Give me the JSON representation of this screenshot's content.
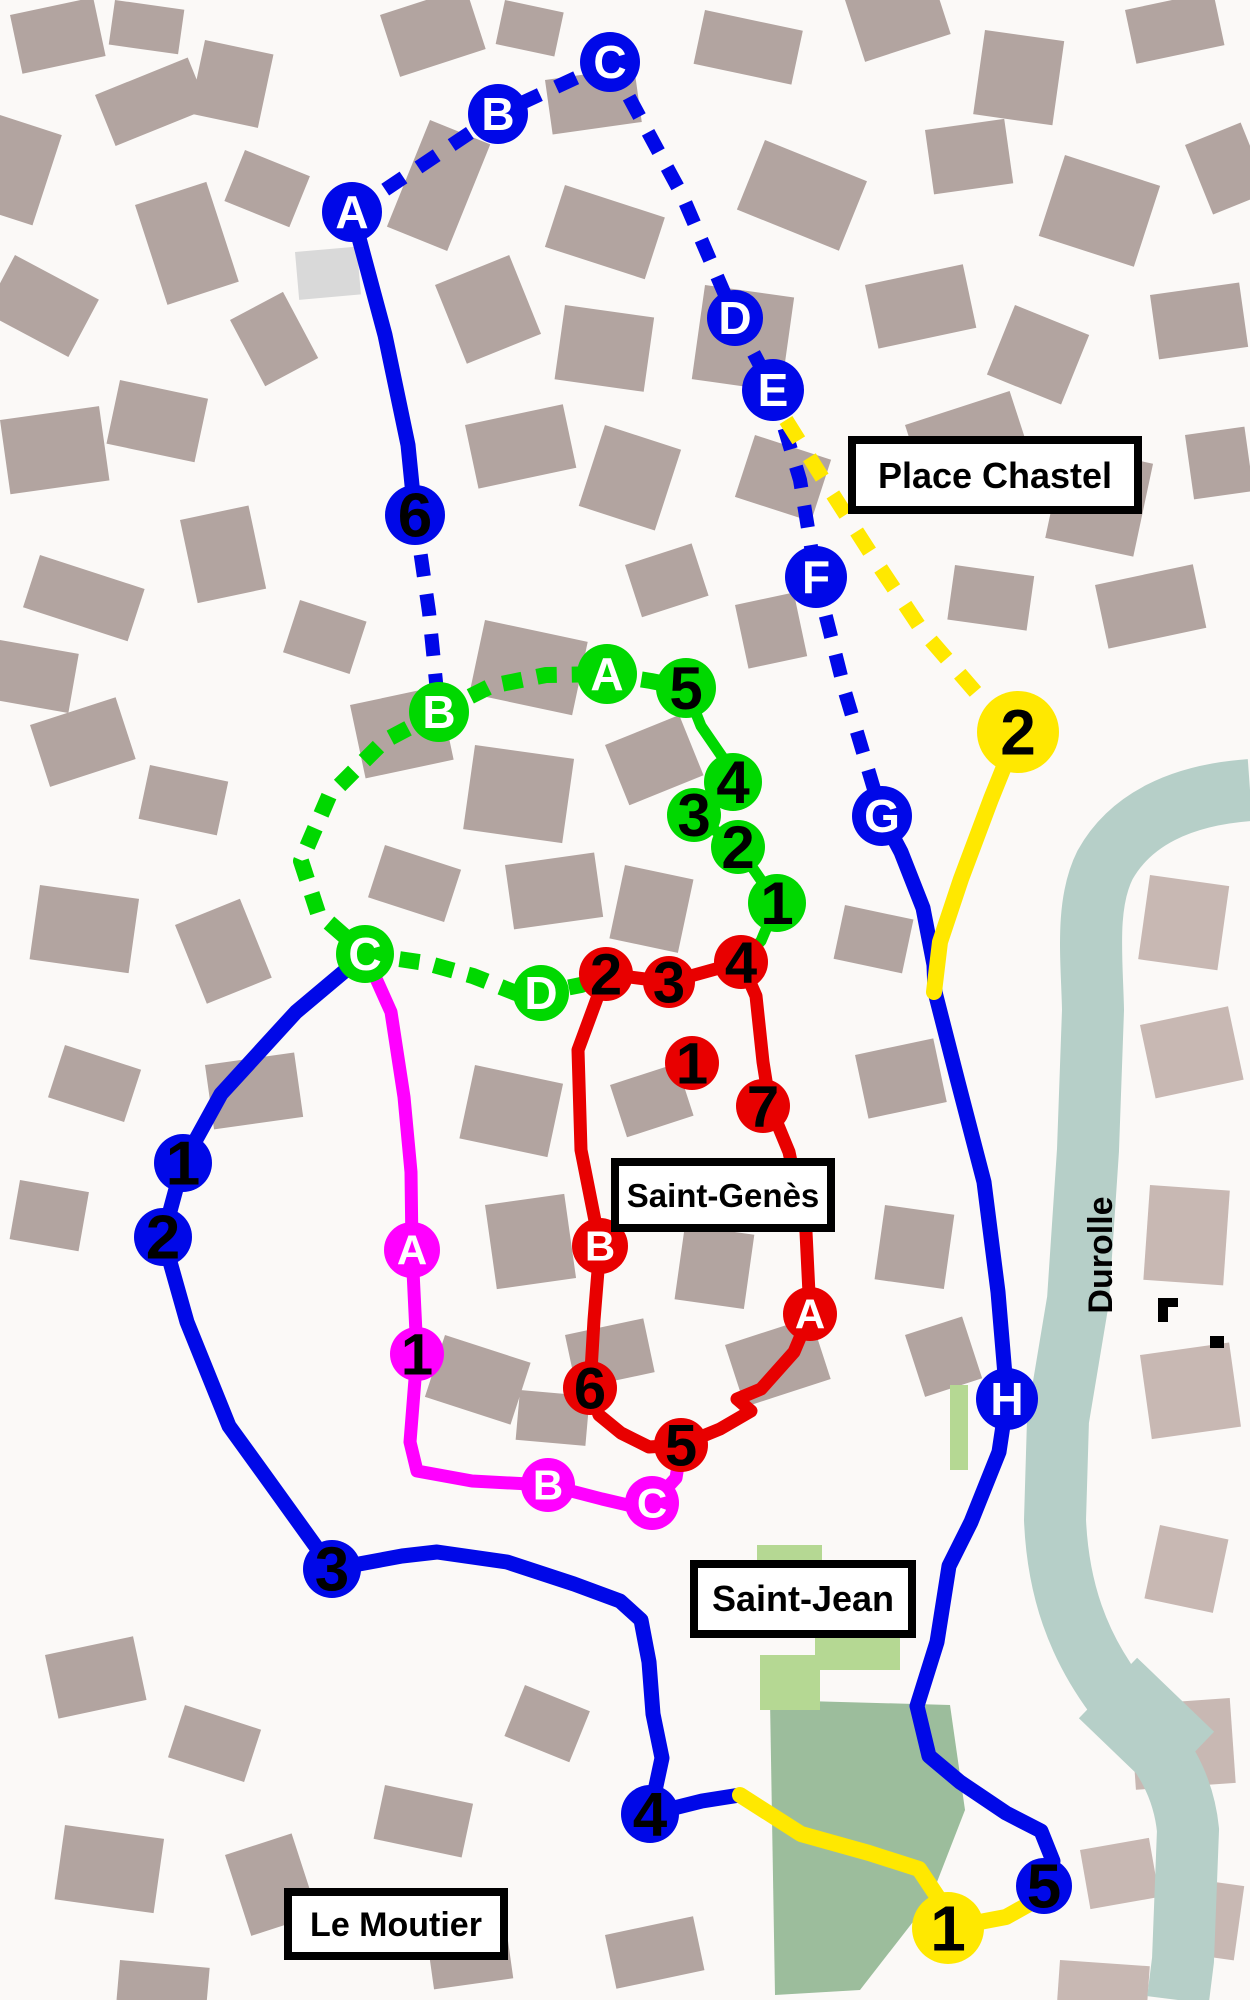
{
  "labels": {
    "place_chastel": "Place Chastel",
    "saint_genes": "Saint-Genès",
    "saint_jean": "Saint-Jean",
    "le_moutier": "Le Moutier",
    "durolle": "Durolle"
  },
  "colors": {
    "background": "#fbf9f7",
    "building": "#b2a4a0",
    "building_light": "#c8b8b3",
    "river": "#b6cfc8",
    "park": "#9cbd9c",
    "park_light": "#b5d893",
    "blue_route": "#0008e8",
    "green_route": "#00d800",
    "red_route": "#e80000",
    "magenta_route": "#ff00ff",
    "yellow_route": "#ffe800"
  },
  "routes": {
    "blue": {
      "color": "#0008e8",
      "width": 15,
      "dash_width": 14,
      "dash": "22 18",
      "letter_fs": 46,
      "number_fs": 62,
      "dashed_paths": [
        [
          [
            352,
            212
          ],
          [
            498,
            114
          ],
          [
            610,
            62
          ]
        ],
        [
          [
            610,
            62
          ],
          [
            682,
            195
          ],
          [
            735,
            318
          ]
        ],
        [
          [
            735,
            318
          ],
          [
            773,
            390
          ]
        ],
        [
          [
            773,
            390
          ],
          [
            800,
            480
          ],
          [
            816,
            577
          ]
        ],
        [
          [
            816,
            577
          ],
          [
            845,
            692
          ],
          [
            882,
            816
          ]
        ],
        [
          [
            415,
            515
          ],
          [
            429,
            612
          ],
          [
            439,
            712
          ]
        ]
      ],
      "solid_paths": [
        [
          [
            352,
            212
          ],
          [
            385,
            335
          ],
          [
            408,
            445
          ],
          [
            415,
            515
          ]
        ],
        [
          [
            882,
            816
          ],
          [
            901,
            852
          ],
          [
            923,
            908
          ],
          [
            934,
            965
          ],
          [
            935,
            992
          ],
          [
            958,
            1082
          ],
          [
            984,
            1182
          ],
          [
            998,
            1292
          ],
          [
            1007,
            1399
          ],
          [
            999,
            1452
          ],
          [
            971,
            1522
          ],
          [
            949,
            1566
          ],
          [
            937,
            1642
          ],
          [
            917,
            1706
          ],
          [
            929,
            1756
          ],
          [
            960,
            1782
          ],
          [
            1006,
            1813
          ],
          [
            1041,
            1831
          ],
          [
            1053,
            1861
          ],
          [
            1044,
            1886
          ]
        ],
        [
          [
            365,
            954
          ],
          [
            296,
            1012
          ],
          [
            221,
            1094
          ],
          [
            183,
            1163
          ],
          [
            163,
            1237
          ],
          [
            187,
            1322
          ],
          [
            229,
            1426
          ],
          [
            263,
            1473
          ],
          [
            332,
            1569
          ],
          [
            402,
            1556
          ],
          [
            437,
            1552
          ],
          [
            507,
            1562
          ],
          [
            574,
            1584
          ],
          [
            620,
            1601
          ],
          [
            641,
            1620
          ],
          [
            649,
            1662
          ],
          [
            653,
            1714
          ],
          [
            662,
            1758
          ],
          [
            650,
            1814
          ],
          [
            702,
            1801
          ],
          [
            740,
            1795
          ]
        ]
      ],
      "stops": [
        {
          "label": "A",
          "x": 352,
          "y": 212,
          "r": 30,
          "kind": "letter"
        },
        {
          "label": "B",
          "x": 498,
          "y": 114,
          "r": 30,
          "kind": "letter"
        },
        {
          "label": "C",
          "x": 610,
          "y": 62,
          "r": 30,
          "kind": "letter"
        },
        {
          "label": "D",
          "x": 735,
          "y": 318,
          "r": 28,
          "kind": "letter"
        },
        {
          "label": "E",
          "x": 773,
          "y": 390,
          "r": 31,
          "kind": "letter"
        },
        {
          "label": "F",
          "x": 816,
          "y": 577,
          "r": 31,
          "kind": "letter"
        },
        {
          "label": "G",
          "x": 882,
          "y": 816,
          "r": 30,
          "kind": "letter"
        },
        {
          "label": "H",
          "x": 1007,
          "y": 1399,
          "r": 31,
          "kind": "letter"
        },
        {
          "label": "6",
          "x": 415,
          "y": 515,
          "r": 30,
          "kind": "number"
        },
        {
          "label": "1",
          "x": 183,
          "y": 1163,
          "r": 29,
          "kind": "number"
        },
        {
          "label": "2",
          "x": 163,
          "y": 1237,
          "r": 29,
          "kind": "number"
        },
        {
          "label": "3",
          "x": 332,
          "y": 1569,
          "r": 29,
          "kind": "number"
        },
        {
          "label": "4",
          "x": 650,
          "y": 1814,
          "r": 29,
          "kind": "number"
        },
        {
          "label": "5",
          "x": 1044,
          "y": 1886,
          "r": 28,
          "kind": "number"
        }
      ]
    },
    "yellow": {
      "color": "#ffe800",
      "width": 16,
      "dash_width": 15,
      "dash": "24 20",
      "letter_fs": 44,
      "number_fs": 64,
      "dashed_paths": [
        [
          [
            786,
            420
          ],
          [
            830,
            490
          ],
          [
            873,
            557
          ],
          [
            921,
            629
          ],
          [
            979,
            696
          ],
          [
            1018,
            732
          ]
        ]
      ],
      "solid_paths": [
        [
          [
            1018,
            732
          ],
          [
            991,
            799
          ],
          [
            961,
            879
          ],
          [
            940,
            942
          ],
          [
            934,
            992
          ]
        ],
        [
          [
            740,
            1795
          ],
          [
            801,
            1834
          ],
          [
            869,
            1853
          ],
          [
            919,
            1869
          ],
          [
            937,
            1896
          ],
          [
            948,
            1928
          ],
          [
            1006,
            1917
          ],
          [
            1031,
            1903
          ],
          [
            1044,
            1886
          ]
        ]
      ],
      "stops": [
        {
          "label": "2",
          "x": 1018,
          "y": 732,
          "r": 41,
          "kind": "number"
        },
        {
          "label": "1",
          "x": 948,
          "y": 1928,
          "r": 36,
          "kind": "number"
        }
      ]
    },
    "green": {
      "color": "#00d800",
      "width": 11,
      "dash_width": 16,
      "dash": "20 15",
      "letter_fs": 46,
      "number_fs": 60,
      "dashed_paths": [
        [
          [
            439,
            712
          ],
          [
            491,
            686
          ],
          [
            546,
            675
          ],
          [
            607,
            674
          ],
          [
            651,
            681
          ],
          [
            686,
            688
          ]
        ],
        [
          [
            439,
            712
          ],
          [
            384,
            741
          ],
          [
            329,
            796
          ],
          [
            301,
            861
          ],
          [
            318,
            913
          ],
          [
            365,
            954
          ]
        ],
        [
          [
            365,
            954
          ],
          [
            426,
            963
          ],
          [
            473,
            976
          ],
          [
            516,
            993
          ],
          [
            541,
            993
          ],
          [
            581,
            985
          ],
          [
            606,
            974
          ]
        ]
      ],
      "solid_paths": [
        [
          [
            686,
            688
          ],
          [
            701,
            726
          ],
          [
            723,
            758
          ],
          [
            733,
            782
          ],
          [
            694,
            815
          ],
          [
            738,
            847
          ],
          [
            777,
            903
          ],
          [
            761,
            941
          ],
          [
            741,
            962
          ]
        ]
      ],
      "stops": [
        {
          "label": "B",
          "x": 439,
          "y": 712,
          "r": 30,
          "kind": "letter"
        },
        {
          "label": "A",
          "x": 607,
          "y": 674,
          "r": 30,
          "kind": "letter"
        },
        {
          "label": "C",
          "x": 365,
          "y": 954,
          "r": 29,
          "kind": "letter"
        },
        {
          "label": "D",
          "x": 541,
          "y": 993,
          "r": 28,
          "kind": "letter"
        },
        {
          "label": "5",
          "x": 686,
          "y": 688,
          "r": 30,
          "kind": "number"
        },
        {
          "label": "4",
          "x": 733,
          "y": 782,
          "r": 29,
          "kind": "number"
        },
        {
          "label": "3",
          "x": 694,
          "y": 815,
          "r": 27,
          "kind": "number"
        },
        {
          "label": "2",
          "x": 738,
          "y": 847,
          "r": 27,
          "kind": "number"
        },
        {
          "label": "1",
          "x": 777,
          "y": 903,
          "r": 29,
          "kind": "number"
        }
      ]
    },
    "magenta": {
      "color": "#ff00ff",
      "width": 13,
      "dash_width": 13,
      "dash": "20 16",
      "letter_fs": 42,
      "number_fs": 58,
      "dashed_paths": [],
      "solid_paths": [
        [
          [
            365,
            954
          ],
          [
            391,
            1012
          ],
          [
            404,
            1097
          ],
          [
            411,
            1172
          ],
          [
            412,
            1250
          ],
          [
            417,
            1354
          ],
          [
            410,
            1442
          ],
          [
            417,
            1471
          ],
          [
            472,
            1481
          ],
          [
            548,
            1485
          ],
          [
            602,
            1499
          ],
          [
            645,
            1509
          ],
          [
            655,
            1501
          ],
          [
            676,
            1478
          ],
          [
            681,
            1447
          ]
        ]
      ],
      "stops": [
        {
          "label": "A",
          "x": 412,
          "y": 1250,
          "r": 28,
          "kind": "letter"
        },
        {
          "label": "1",
          "x": 417,
          "y": 1354,
          "r": 27,
          "kind": "number"
        },
        {
          "label": "B",
          "x": 548,
          "y": 1485,
          "r": 27,
          "kind": "letter"
        },
        {
          "label": "C",
          "x": 652,
          "y": 1503,
          "r": 27,
          "kind": "letter"
        }
      ]
    },
    "red": {
      "color": "#e80000",
      "width": 13,
      "dash_width": 13,
      "dash": "20 16",
      "letter_fs": 42,
      "number_fs": 58,
      "dashed_paths": [],
      "solid_paths": [
        [
          [
            606,
            974
          ],
          [
            669,
            982
          ],
          [
            741,
            962
          ],
          [
            756,
            996
          ],
          [
            763,
            1062
          ],
          [
            770,
            1106
          ],
          [
            789,
            1152
          ],
          [
            806,
            1232
          ],
          [
            810,
            1314
          ],
          [
            794,
            1352
          ],
          [
            761,
            1389
          ],
          [
            737,
            1399
          ],
          [
            751,
            1411
          ],
          [
            720,
            1429
          ],
          [
            681,
            1445
          ],
          [
            649,
            1447
          ],
          [
            621,
            1433
          ],
          [
            599,
            1415
          ],
          [
            590,
            1388
          ],
          [
            594,
            1320
          ],
          [
            600,
            1246
          ],
          [
            581,
            1150
          ],
          [
            578,
            1050
          ],
          [
            606,
            974
          ]
        ]
      ],
      "stops": [
        {
          "label": "2",
          "x": 606,
          "y": 974,
          "r": 27,
          "kind": "number"
        },
        {
          "label": "3",
          "x": 669,
          "y": 982,
          "r": 26,
          "kind": "number"
        },
        {
          "label": "4",
          "x": 741,
          "y": 962,
          "r": 27,
          "kind": "number"
        },
        {
          "label": "1",
          "x": 692,
          "y": 1063,
          "r": 27,
          "kind": "number"
        },
        {
          "label": "7",
          "x": 763,
          "y": 1106,
          "r": 27,
          "kind": "number"
        },
        {
          "label": "B",
          "x": 600,
          "y": 1246,
          "r": 28,
          "kind": "letter"
        },
        {
          "label": "A",
          "x": 810,
          "y": 1314,
          "r": 27,
          "kind": "letter"
        },
        {
          "label": "6",
          "x": 590,
          "y": 1388,
          "r": 27,
          "kind": "number"
        },
        {
          "label": "5",
          "x": 681,
          "y": 1445,
          "r": 27,
          "kind": "number"
        }
      ]
    }
  }
}
